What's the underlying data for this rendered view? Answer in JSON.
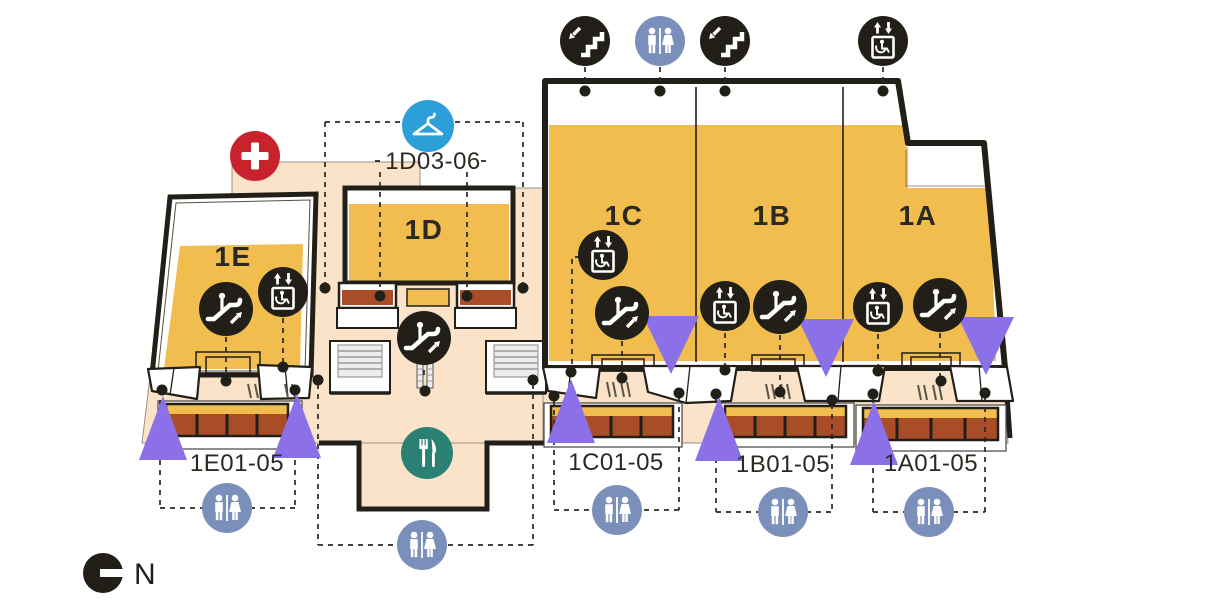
{
  "page": {
    "background": "#ffffff"
  },
  "map": {
    "name": "level-1-floor-plan",
    "compass": {
      "label": "N"
    },
    "zones": [
      {
        "label": "1A",
        "units": "1A01-05"
      },
      {
        "label": "1B",
        "units": "1B01-05"
      },
      {
        "label": "1C",
        "units": "1C01-05"
      },
      {
        "label": "1D",
        "units": "1D03-06"
      },
      {
        "label": "1E",
        "units": "1E01-05"
      }
    ],
    "icons": [
      "stairs-icon",
      "restroom-icon",
      "accessible-elevator-icon",
      "escalator-icon",
      "first-aid-icon",
      "cloakroom-icon",
      "food-court-icon",
      "north-compass-icon",
      "entrance-marker-triangle"
    ],
    "colors": {
      "walkway": "#fae3c8",
      "zone_fill": "#f0bd4e",
      "shopfront": "#a94d28",
      "outline": "#211f18",
      "entrance_marker": "#8b70e8",
      "restroom": "#7b8fbb",
      "cloakroom": "#2d9fd8",
      "first_aid": "#c8232c",
      "food_court": "#2a8073"
    }
  }
}
